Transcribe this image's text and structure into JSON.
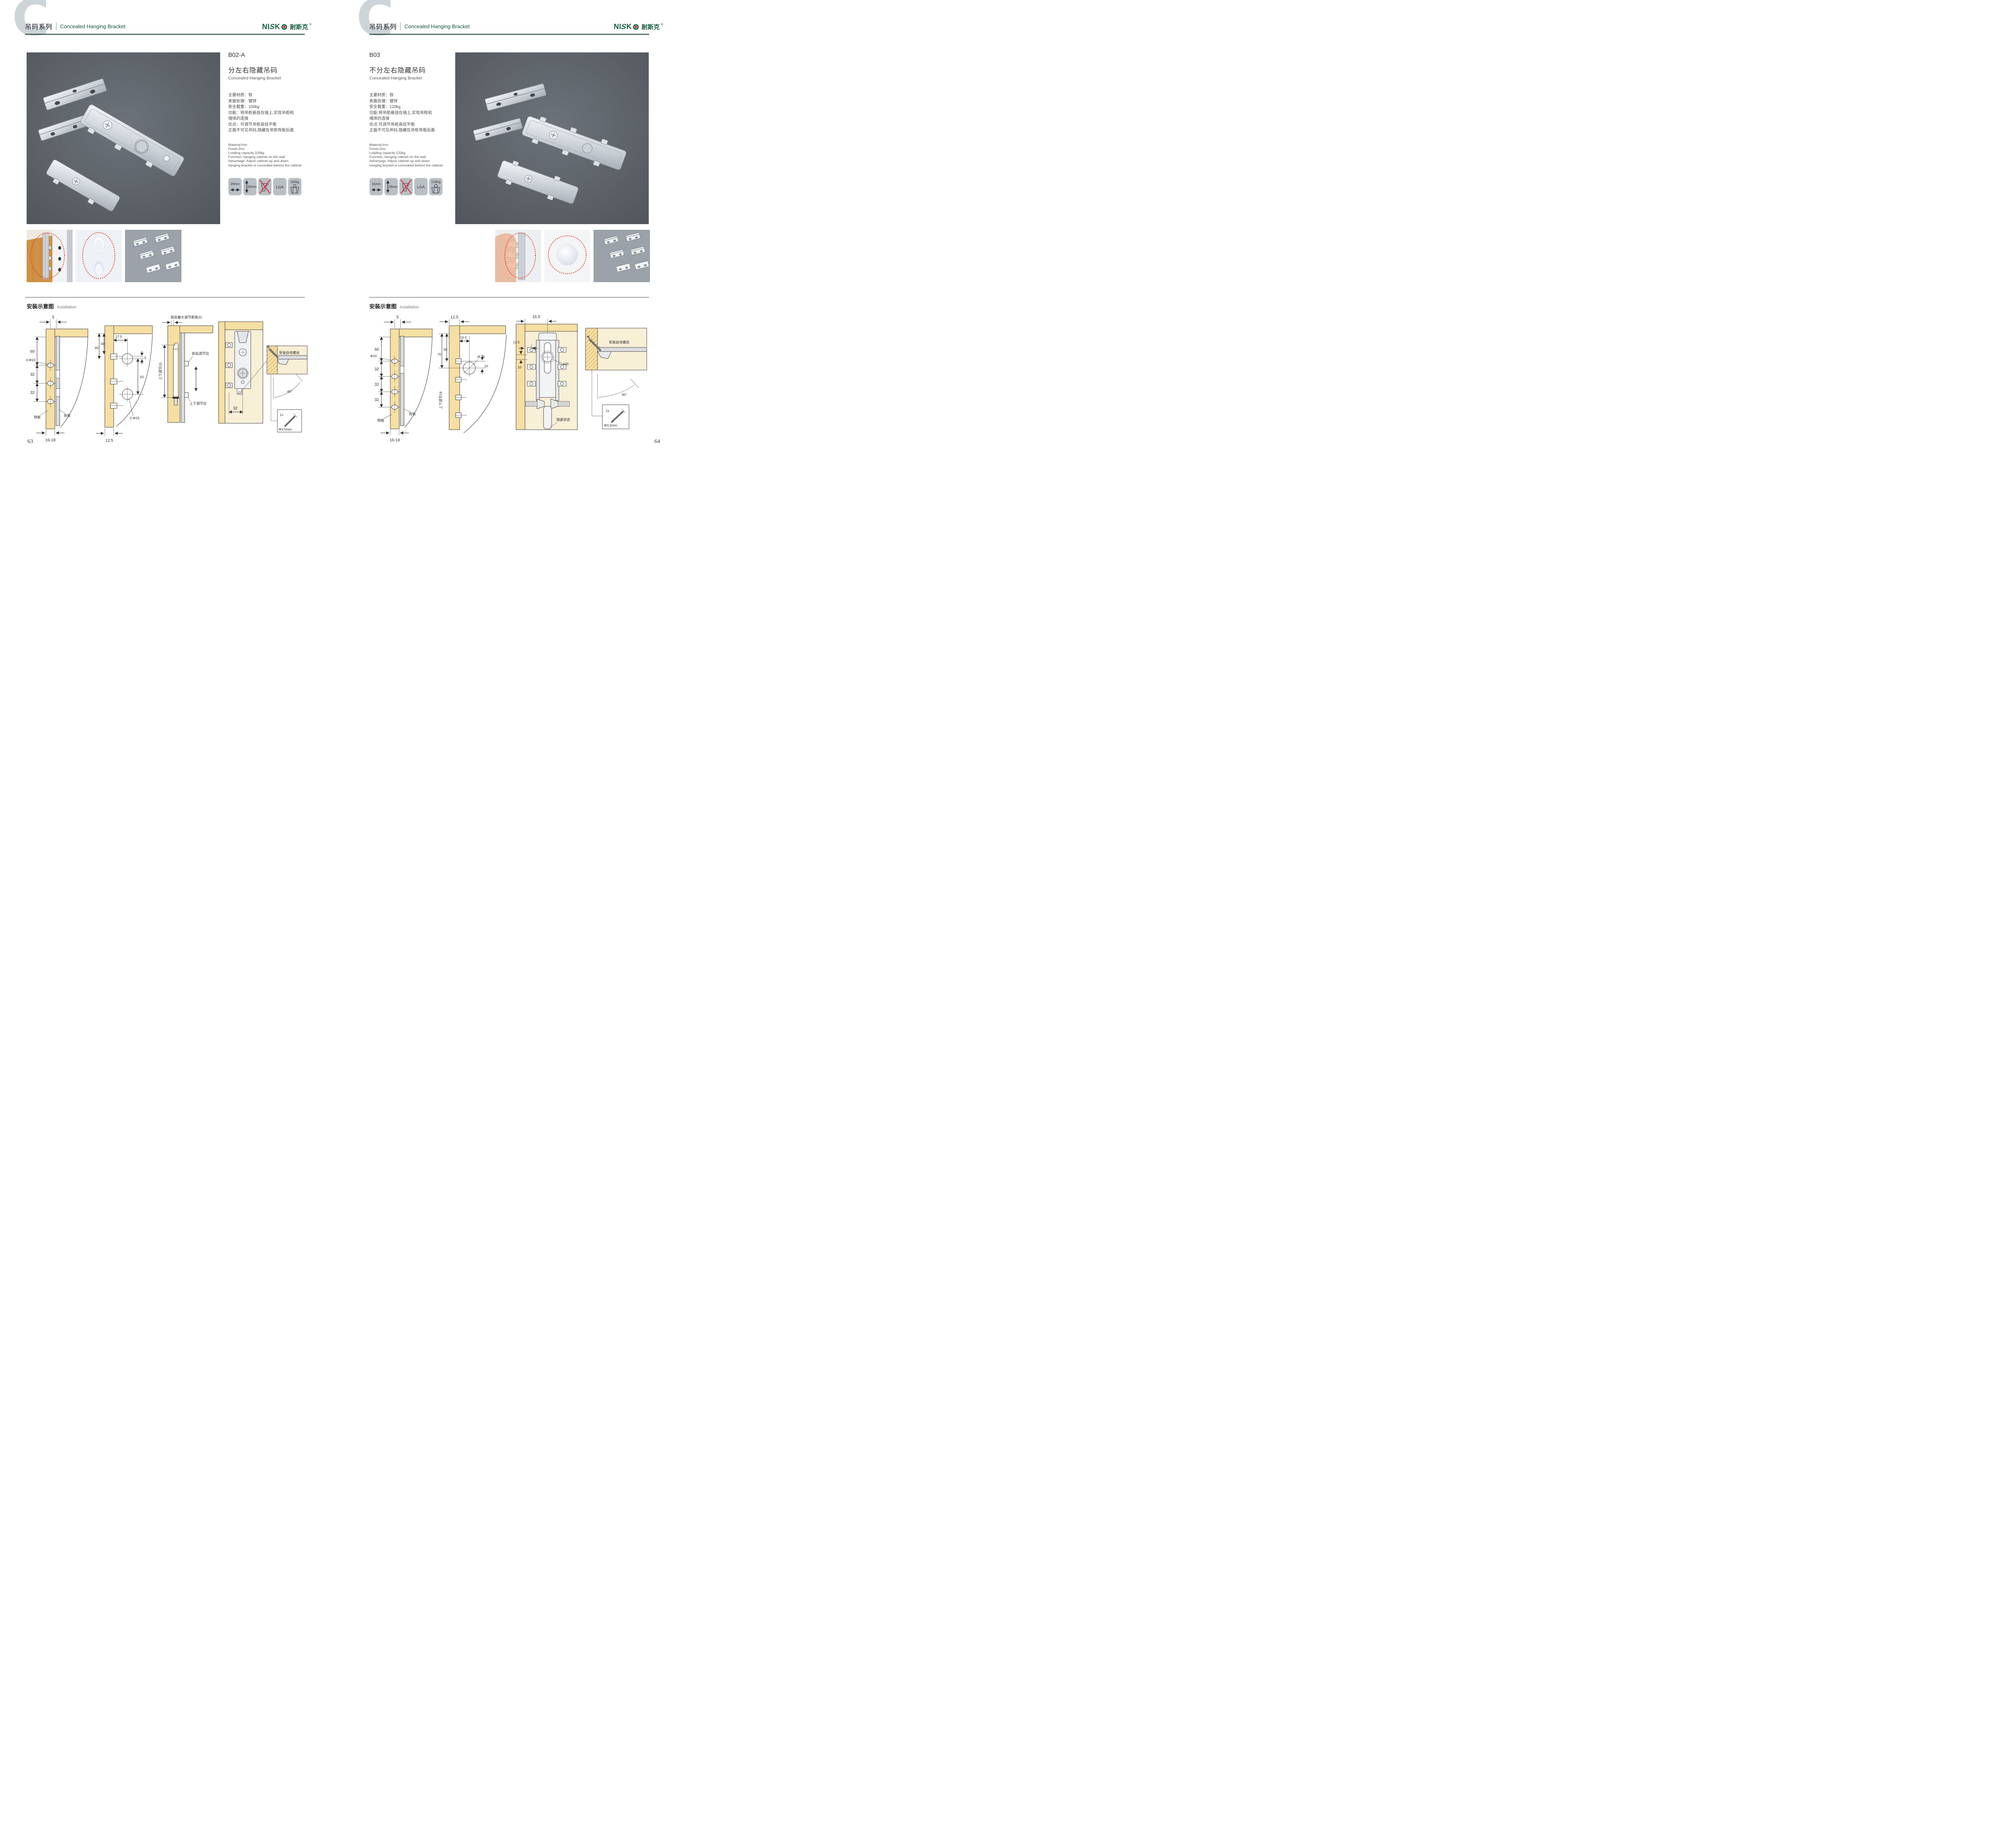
{
  "header": {
    "bg_letter": "C",
    "series_zh": "吊码系列",
    "series_en": "Concealed Hanging Bracket"
  },
  "brand": {
    "name_1": "NI",
    "name_2": "S",
    "name_3": "K",
    "name_zh": "耐斯克",
    "reg": "®"
  },
  "installation": {
    "title_zh": "安装示意图",
    "title_en": "Installation"
  },
  "colors": {
    "brand_green": "#175e41",
    "header_rule_green": "#12392a",
    "wood_yellow": "#f6dfa2",
    "badge_gray": "#b9bfc4",
    "highlight_red": "#e53e2e"
  },
  "left_page": {
    "page_number": "63",
    "product": {
      "model": "B02-A",
      "name_zh": "分左右隐藏吊码",
      "name_en": "Concealed Hanging Bracket",
      "specs_zh": [
        "主要材质：铁",
        "表面处理：镀锌",
        "安全载重：100kg",
        "功能：将吊柜悬挂在墙上,实现吊柜和",
        "墙体的连接",
        "优点：可调节吊柜高低平衡",
        "正面不可见吊码,隐藏在吊柜背板后面"
      ],
      "specs_en": [
        "Material:Iron",
        "Finish:Zinc",
        "Loading capacity:100kg",
        "Function: hanging cabinet on the wall",
        "Advantage: Adjust cabinet up and down",
        "hanging bracket is concealed behind the cabinet"
      ],
      "badges": [
        {
          "icon": "width-arrow-icon",
          "label": "20mm"
        },
        {
          "icon": "height-arrow-icon",
          "label": "20mm"
        },
        {
          "icon": "no-drill-icon",
          "label": ""
        },
        {
          "icon": "lga-icon",
          "label": "LGA"
        },
        {
          "icon": "load-weight-icon",
          "label": "100kg"
        }
      ]
    },
    "diagrams": {
      "d1": {
        "top": "5",
        "v1": "60",
        "hole": "3-Φ10",
        "v2": "32",
        "v3": "32",
        "side": "侧板",
        "back": "背板",
        "bottom": "16-18"
      },
      "d2": {
        "v1": "65",
        "v2": "60",
        "h1": "17.5",
        "offset": "5",
        "v3": "50",
        "hole": "2-Φ15",
        "bottom": "12.5"
      },
      "d3": {
        "top": "前后最大调节距离20",
        "side": "上下调节20",
        "c1": "前后调节位",
        "c2": "上下调节位"
      },
      "d4": {
        "dim": "32",
        "callout": "安装自攻螺丝",
        "angle": "45°",
        "qty": "1x",
        "size": "Φ3.5mm"
      }
    }
  },
  "right_page": {
    "page_number": "64",
    "product": {
      "model": "B03",
      "name_zh": "不分左右隐藏吊码",
      "name_en": "Concealed Hanging Bracket",
      "specs_zh": [
        "主要材质：铁",
        "表面处理：镀锌",
        "安全载重：120kg",
        "功能:将吊柜悬挂在墙上,实现吊柜和",
        "墙体的连接",
        "优点:可调节吊柜高低平衡",
        "正面不可见吊码,隐藏在吊柜背板后面"
      ],
      "specs_en": [
        "Material:Iron",
        "Finish:Zinc",
        "Loading capacity:120kg",
        "Function: hanging cabinet on the wall",
        "Advantage: Adjust cabinet up and down",
        "hanging bracket is concealed behind the cabinet"
      ],
      "badges": [
        {
          "icon": "width-arrow-icon",
          "label": "15mm"
        },
        {
          "icon": "height-arrow-icon",
          "label": "18mm"
        },
        {
          "icon": "no-drill-icon",
          "label": ""
        },
        {
          "icon": "lga-icon",
          "label": "LGA"
        },
        {
          "icon": "load-weight-icon",
          "label": "120Kg"
        }
      ]
    },
    "diagrams": {
      "d1": {
        "top": "5",
        "v1": "60",
        "hole": "Φ10",
        "v2": "32",
        "v3": "32",
        "v4": "32",
        "back": "背板",
        "side": "侧板",
        "bottom": "16-18"
      },
      "d2": {
        "top": "12.5",
        "h1": "16.5",
        "v1": "70",
        "v2": "60",
        "hole": "Ø 25",
        "offset": "10",
        "side": "上下调节18"
      },
      "d3": {
        "top": "16.5",
        "d1": "12.5",
        "d2": "10",
        "hole": "ø25",
        "callout": "锁紧状态"
      },
      "d4": {
        "callout": "安装自攻螺丝",
        "angle": "45°",
        "qty": "1x",
        "size": "Φ3.5mm"
      }
    }
  }
}
